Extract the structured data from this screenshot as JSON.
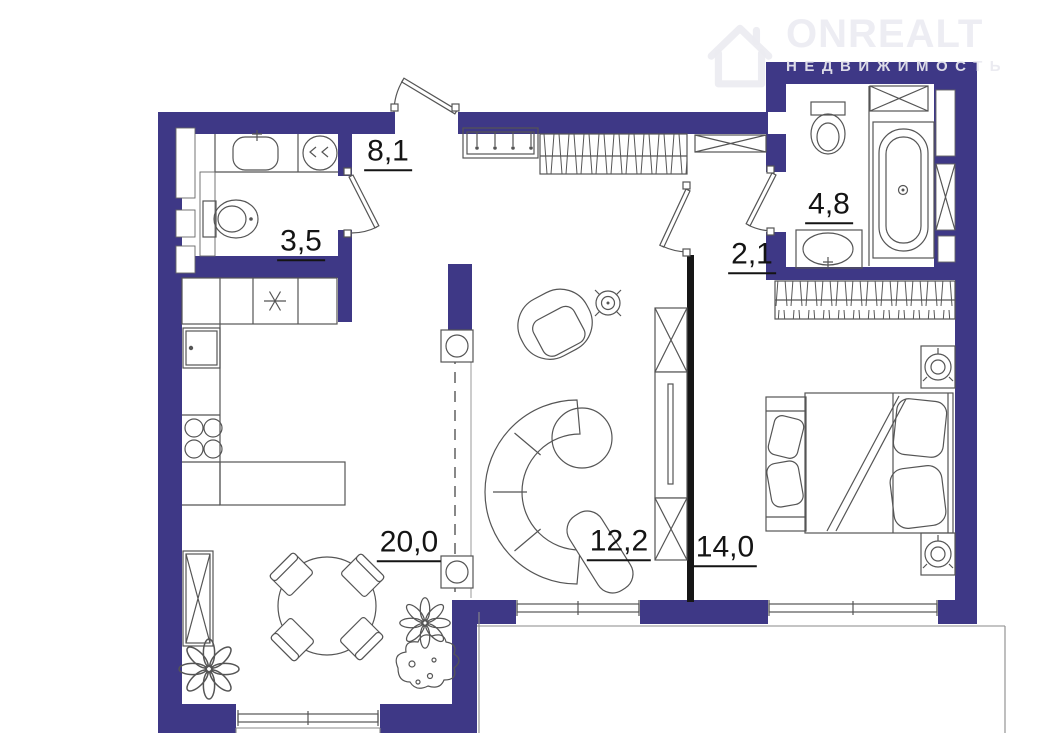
{
  "logo": {
    "brand": "ONREALT",
    "subtitle": "НЕДВИЖИМОСТЬ",
    "icon": "house-icon"
  },
  "rooms": [
    {
      "name": "hallway",
      "area": "8,1"
    },
    {
      "name": "wc",
      "area": "3,5"
    },
    {
      "name": "bathroom",
      "area": "4,8"
    },
    {
      "name": "vestibule",
      "area": "2,1"
    },
    {
      "name": "kitchen-dining",
      "area": "20,0"
    },
    {
      "name": "living-room",
      "area": "12,2"
    },
    {
      "name": "bedroom",
      "area": "14,0"
    }
  ],
  "colors": {
    "wall": "#3e3886",
    "partition": "#161616",
    "line": "#555555",
    "label": "#141414",
    "logo": "#ebebf0"
  }
}
